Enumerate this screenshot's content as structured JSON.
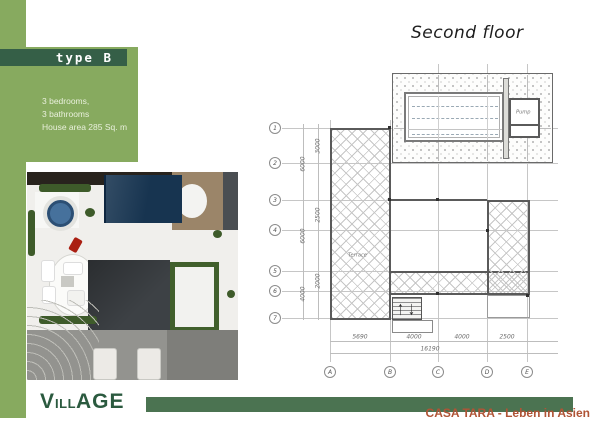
{
  "page": {
    "second_floor_title": "Second floor",
    "brand_v": "V",
    "brand_ill": "ILL",
    "brand_age": "AGE",
    "tagline": "CASA TARA - Leben in Asien"
  },
  "type_panel": {
    "label": "type B",
    "spec_line1": "3 bedrooms,",
    "spec_line2": "3 bathrooms",
    "spec_line3": "House area 285 Sq. m"
  },
  "plan": {
    "rows": [
      "1",
      "2",
      "3",
      "4",
      "5",
      "6",
      "7"
    ],
    "cols": [
      "A",
      "B",
      "C",
      "D",
      "E"
    ],
    "dims_inner": [
      "3000",
      "2500",
      "2000"
    ],
    "dims_outer": [
      "6000",
      "6000",
      "4000"
    ],
    "dims_bottom": [
      "5690",
      "4000",
      "4000",
      "2500"
    ],
    "dims_total": "16190",
    "terrace_label": "Terrace",
    "pump_label": "Pump"
  },
  "colors": {
    "panel_green": "#87aa5f",
    "banner_green": "#355f47",
    "footer_bar_green": "#4b7351",
    "logo_green": "#2b5a3f",
    "tagline_color": "#b05436",
    "pool_blue": "#173450"
  }
}
